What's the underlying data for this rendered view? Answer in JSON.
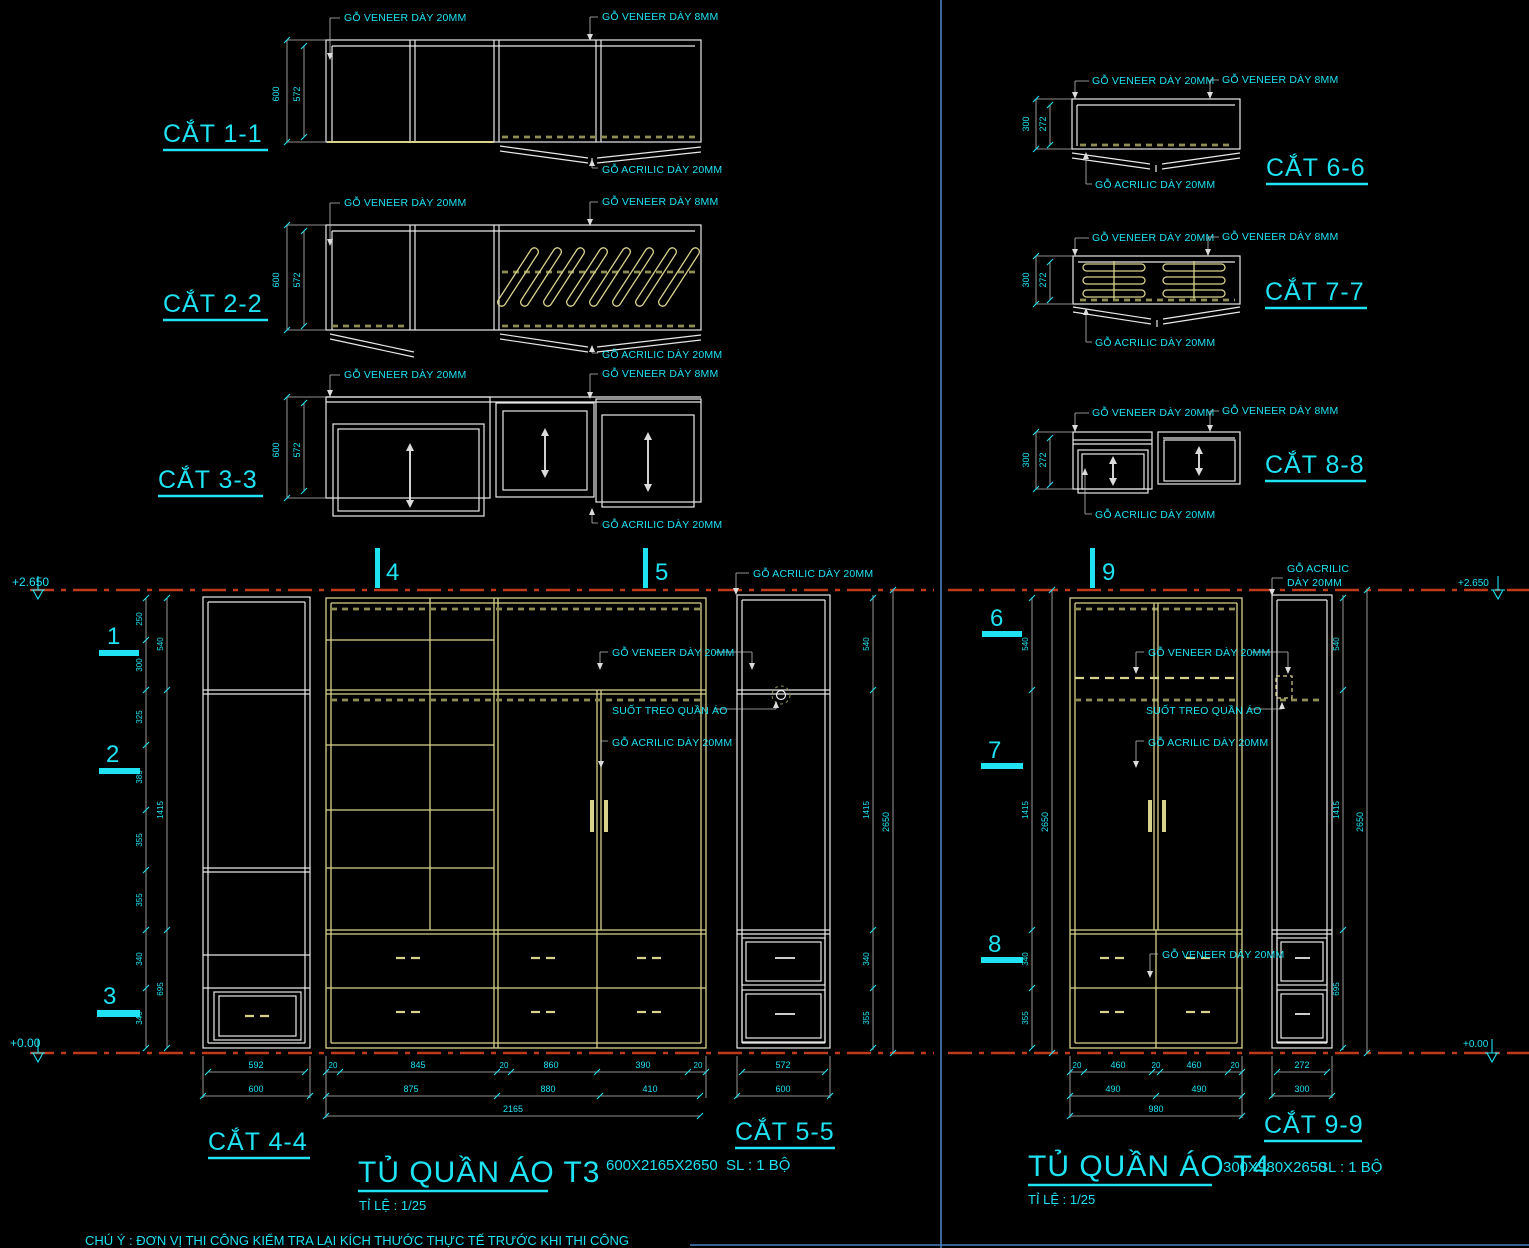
{
  "labels": {
    "veneer20": "GỖ VENEER DÀY 20MM",
    "veneer8": "GỖ VENEER DÀY 8MM",
    "acrilic20": "GỖ ACRILIC DÀY 20MM",
    "acrilic_l1": "GỖ ACRILIC",
    "acrilic_l2": "DÀY 20MM",
    "hanger_rail": "SUỐT TREO QUẦN ÁO"
  },
  "cuts": {
    "c11": "CẮT 1-1",
    "c22": "CẮT 2-2",
    "c33": "CẮT 3-3",
    "c44": "CẮT 4-4",
    "c55": "CẮT 5-5",
    "c66": "CẮT 6-6",
    "c77": "CẮT 7-7",
    "c88": "CẮT 8-8",
    "c99": "CẮT 9-9"
  },
  "markers": {
    "m1": "1",
    "m2": "2",
    "m3": "3",
    "m4": "4",
    "m5": "5",
    "m6": "6",
    "m7": "7",
    "m8": "8",
    "m9": "9"
  },
  "levels": {
    "top": "+2.650",
    "bottom": "+0.00"
  },
  "t3": {
    "title": "TỦ QUẦN ÁO T3",
    "scale": "TỈ LỆ : 1/25",
    "size": "600X2165X2650",
    "qty": "SL : 1 BỘ",
    "depth": {
      "outer": "600",
      "inner": "572"
    },
    "side": {
      "outer": "600",
      "inner": "592"
    },
    "col": {
      "outer": "600",
      "inner": "572"
    },
    "front_t1": [
      "20",
      "845",
      "20",
      "860",
      "390",
      "20"
    ],
    "front_t2": [
      "875",
      "880",
      "410"
    ],
    "front_total": "2165",
    "hsegs": [
      "250",
      "300",
      "325",
      "385",
      "355",
      "355",
      "340",
      "340"
    ],
    "hgrps": [
      "540",
      "1415",
      "695"
    ],
    "hsegs4": [
      "540",
      "1415",
      "340",
      "355"
    ],
    "htotal": "2650"
  },
  "t4": {
    "title": "TỦ QUẦN ÁO T4",
    "scale": "TỈ LỆ : 1/25",
    "size": "300X980X2650",
    "qty": "SL : 1 BỘ",
    "depth": {
      "outer": "300",
      "inner": "272"
    },
    "col": {
      "outer": "300",
      "inner": "272"
    },
    "front_t1": [
      "20",
      "460",
      "20",
      "460",
      "20"
    ],
    "front_t2": [
      "490",
      "490"
    ],
    "front_total": "980",
    "hsegs": [
      "540",
      "1415",
      "340",
      "355"
    ],
    "hgrps": [
      "540",
      "1415",
      "695"
    ],
    "htotal": "2650"
  },
  "note": "CHÚ Ý :  ĐƠN VỊ THI CÔNG KIỂM TRA LẠI KÍCH THƯỚC THỰC TẾ TRƯỚC KHI THI CÔNG",
  "colors": {
    "cyan": "#1fe2f2",
    "white": "#e8e8e8",
    "yellow": "#d8d28d",
    "khaki": "#8e8e54",
    "red": "#bf3a18",
    "blue": "#4d7fc4",
    "background": "#000000"
  }
}
